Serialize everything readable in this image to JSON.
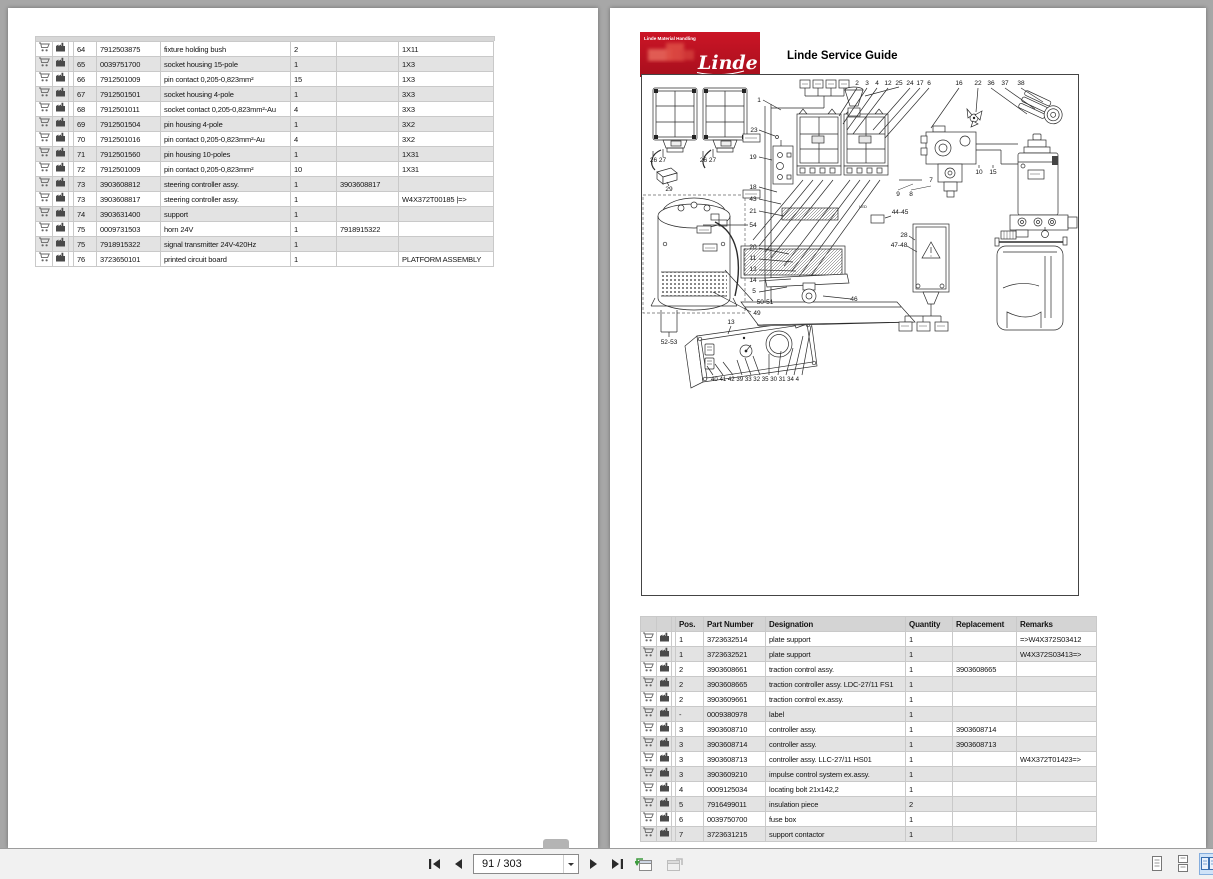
{
  "toolbar": {
    "page_indicator": "91 / 303",
    "icons": {
      "first_page": "skip-to-first-icon",
      "previous_page": "triangle-left-icon",
      "next_page": "triangle-right-icon",
      "last_page": "skip-to-last-icon",
      "previous_view": "previous-view-icon",
      "next_view": "next-view-icon",
      "single_page": "single-page-layout-icon",
      "continuous": "continuous-layout-icon",
      "facing_pages": "facing-pages-layout-icon"
    }
  },
  "colors": {
    "viewer_background": "#a7a7a7",
    "page_background": "#ffffff",
    "brand_red": "#c0111f",
    "row_alt_gray": "#e3e3e3",
    "table_header_gray": "#d4d4d4",
    "layout_selected_blue": "#cfe3f8"
  },
  "left_page": {
    "table": {
      "rows": [
        [
          "64",
          "7912503875",
          "fixture holding bush",
          "2",
          "",
          "1X11"
        ],
        [
          "65",
          "0039751700",
          "socket housing 15-pole",
          "1",
          "",
          "1X3"
        ],
        [
          "66",
          "7912501009",
          "pin contact 0,205-0,823mm²",
          "15",
          "",
          "1X3"
        ],
        [
          "67",
          "7912501501",
          "socket housing 4-pole",
          "1",
          "",
          "3X3"
        ],
        [
          "68",
          "7912501011",
          "socket contact 0,205-0,823mm²-Au",
          "4",
          "",
          "3X3"
        ],
        [
          "69",
          "7912501504",
          "pin housing 4-pole",
          "1",
          "",
          "3X2"
        ],
        [
          "70",
          "7912501016",
          "pin contact 0,205-0,823mm²-Au",
          "4",
          "",
          "3X2"
        ],
        [
          "71",
          "7912501560",
          "pin housing 10-poles",
          "1",
          "",
          "1X31"
        ],
        [
          "72",
          "7912501009",
          "pin contact 0,205-0,823mm²",
          "10",
          "",
          "1X31"
        ],
        [
          "73",
          "3903608812",
          "steering controller assy.",
          "1",
          "3903608817",
          ""
        ],
        [
          "73",
          "3903608817",
          "steering controller assy.",
          "1",
          "",
          "W4X372T00185 |=>"
        ],
        [
          "74",
          "3903631400",
          "support",
          "1",
          "",
          ""
        ],
        [
          "75",
          "0009731503",
          "horn 24V",
          "1",
          "7918915322",
          ""
        ],
        [
          "75",
          "7918915322",
          "signal transmitter 24V-420Hz",
          "1",
          "",
          ""
        ],
        [
          "76",
          "3723650101",
          "printed circuit board",
          "1",
          "",
          "PLATFORM ASSEMBLY"
        ]
      ]
    }
  },
  "right_page": {
    "logo": {
      "top_text": "Linde Material Handling",
      "brand": "Linde"
    },
    "title": "Linde Service Guide",
    "diagram": {
      "callouts": [
        {
          "t": "2",
          "x": 216,
          "y": 11
        },
        {
          "t": "3",
          "x": 226,
          "y": 11
        },
        {
          "t": "4",
          "x": 236,
          "y": 11
        },
        {
          "t": "12",
          "x": 247,
          "y": 11
        },
        {
          "t": "25",
          "x": 258,
          "y": 11
        },
        {
          "t": "24",
          "x": 269,
          "y": 11
        },
        {
          "t": "17",
          "x": 279,
          "y": 11
        },
        {
          "t": "6",
          "x": 288,
          "y": 11
        },
        {
          "t": "16",
          "x": 318,
          "y": 11
        },
        {
          "t": "22",
          "x": 337,
          "y": 11
        },
        {
          "t": "36",
          "x": 350,
          "y": 11
        },
        {
          "t": "37",
          "x": 364,
          "y": 11
        },
        {
          "t": "38",
          "x": 380,
          "y": 11
        },
        {
          "t": "1",
          "x": 118,
          "y": 28
        },
        {
          "t": "23",
          "x": 113,
          "y": 58
        },
        {
          "t": "19",
          "x": 112,
          "y": 85
        },
        {
          "t": "18",
          "x": 112,
          "y": 115
        },
        {
          "t": "43",
          "x": 112,
          "y": 127
        },
        {
          "t": "21",
          "x": 112,
          "y": 139
        },
        {
          "t": "54",
          "x": 112,
          "y": 153
        },
        {
          "t": "20",
          "x": 112,
          "y": 175
        },
        {
          "t": "11",
          "x": 112,
          "y": 186
        },
        {
          "t": "13",
          "x": 112,
          "y": 197
        },
        {
          "t": "14",
          "x": 112,
          "y": 208
        },
        {
          "t": "5",
          "x": 113,
          "y": 219
        },
        {
          "t": "50-51",
          "x": 124,
          "y": 230
        },
        {
          "t": "49",
          "x": 116,
          "y": 241
        },
        {
          "t": "26 27",
          "x": 17,
          "y": 88
        },
        {
          "t": "26 27",
          "x": 67,
          "y": 88
        },
        {
          "t": "29",
          "x": 28,
          "y": 117
        },
        {
          "t": "52-53",
          "x": 28,
          "y": 270
        },
        {
          "t": "13",
          "x": 90,
          "y": 250
        },
        {
          "t": "40 41 42 39 33 32 35 30 31 34 4",
          "x": 70,
          "y": 307,
          "anchor": "start",
          "w": 88,
          "size": 6
        },
        {
          "t": "7",
          "x": 290,
          "y": 108
        },
        {
          "t": "9",
          "x": 257,
          "y": 122
        },
        {
          "t": "8",
          "x": 270,
          "y": 122
        },
        {
          "t": "10",
          "x": 338,
          "y": 100
        },
        {
          "t": "15",
          "x": 352,
          "y": 100
        },
        {
          "t": "44-45",
          "x": 259,
          "y": 140
        },
        {
          "t": "28",
          "x": 263,
          "y": 163
        },
        {
          "t": "47-48",
          "x": 258,
          "y": 173
        },
        {
          "t": "46",
          "x": 213,
          "y": 227
        },
        {
          "t": "LED",
          "x": 222,
          "y": 134,
          "size": 4
        }
      ]
    },
    "table": {
      "headers": [
        "Pos.",
        "Part Number",
        "Designation",
        "Quantity",
        "Replacement",
        "Remarks"
      ],
      "rows": [
        [
          "1",
          "3723632514",
          "plate support",
          "1",
          "",
          "=>W4X372S03412"
        ],
        [
          "1",
          "3723632521",
          "plate support",
          "1",
          "",
          "W4X372S03413=>"
        ],
        [
          "2",
          "3903608661",
          "traction control assy.",
          "1",
          "3903608665",
          ""
        ],
        [
          "2",
          "3903608665",
          "traction controller assy. LDC-27/11 FS1",
          "1",
          "",
          ""
        ],
        [
          "2",
          "3903609661",
          "traction control ex.assy.",
          "1",
          "",
          ""
        ],
        [
          "-",
          "0009380978",
          "label",
          "1",
          "",
          ""
        ],
        [
          "3",
          "3903608710",
          "controller assy.",
          "1",
          "3903608714",
          ""
        ],
        [
          "3",
          "3903608714",
          "controller assy.",
          "1",
          "3903608713",
          ""
        ],
        [
          "3",
          "3903608713",
          "controller assy. LLC-27/11 HS01",
          "1",
          "",
          "W4X372T01423=>"
        ],
        [
          "3",
          "3903609210",
          "impulse control system ex.assy.",
          "1",
          "",
          ""
        ],
        [
          "4",
          "0009125034",
          "locating bolt 21x142,2",
          "1",
          "",
          ""
        ],
        [
          "5",
          "7916499011",
          "insulation piece",
          "2",
          "",
          ""
        ],
        [
          "6",
          "0039750700",
          "fuse box",
          "1",
          "",
          ""
        ],
        [
          "7",
          "3723631215",
          "support contactor",
          "1",
          "",
          ""
        ]
      ]
    }
  }
}
